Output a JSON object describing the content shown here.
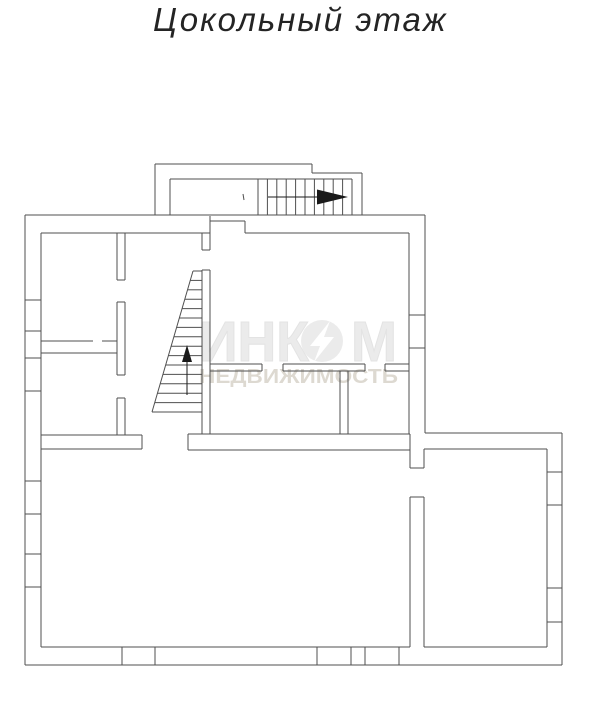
{
  "title": "Цокольный этаж",
  "watermark": {
    "brand_left": "ИНК",
    "brand_right": "М",
    "subtitle": "НЕДВИЖИМОСТЬ",
    "color_big": "#ebebeb",
    "color_big_outline": "#e3e3e3",
    "color_bolt": "#ffffff",
    "color_sub": "#ddd9d1"
  },
  "plan": {
    "stroke": "#4f4f4f",
    "arrow_color": "#1a1a1a",
    "groups": {
      "walls": {
        "lines": [
          [
            25,
            215,
            425,
            215
          ],
          [
            425,
            215,
            425,
            433
          ],
          [
            425,
            433,
            562,
            433
          ],
          [
            562,
            433,
            562,
            665
          ],
          [
            562,
            665,
            25,
            665
          ],
          [
            25,
            665,
            25,
            215
          ],
          [
            41,
            233,
            210,
            233
          ],
          [
            245,
            233,
            409,
            233
          ],
          [
            210,
            216,
            210,
            233
          ],
          [
            210,
            221,
            245,
            221
          ],
          [
            245,
            221,
            245,
            233
          ],
          [
            41,
            233,
            41,
            647
          ],
          [
            41,
            647,
            410,
            647
          ],
          [
            409,
            233,
            409,
            434
          ],
          [
            424,
            449,
            547,
            449
          ],
          [
            547,
            449,
            547,
            647
          ],
          [
            424,
            647,
            547,
            647
          ],
          [
            410,
            434,
            410,
            468
          ],
          [
            424,
            449,
            424,
            468
          ],
          [
            410,
            468,
            424,
            468
          ],
          [
            410,
            497,
            424,
            497
          ],
          [
            410,
            497,
            410,
            647
          ],
          [
            424,
            497,
            424,
            647
          ],
          [
            41,
            435,
            142,
            435
          ],
          [
            41,
            449,
            142,
            449
          ],
          [
            142,
            435,
            142,
            449
          ],
          [
            188,
            434,
            410,
            434
          ],
          [
            188,
            450,
            410,
            450
          ],
          [
            188,
            434,
            188,
            450
          ],
          [
            117,
            233,
            117,
            280
          ],
          [
            125,
            233,
            125,
            280
          ],
          [
            117,
            280,
            125,
            280
          ],
          [
            117,
            302,
            117,
            375
          ],
          [
            125,
            302,
            125,
            375
          ],
          [
            117,
            302,
            125,
            302
          ],
          [
            117,
            375,
            125,
            375
          ],
          [
            117,
            398,
            117,
            435
          ],
          [
            125,
            398,
            125,
            435
          ],
          [
            117,
            398,
            125,
            398
          ],
          [
            41,
            341,
            93,
            341
          ],
          [
            102,
            341,
            117,
            341
          ],
          [
            41,
            353,
            117,
            353
          ],
          [
            210,
            364,
            262,
            364
          ],
          [
            210,
            371,
            262,
            371
          ],
          [
            262,
            364,
            262,
            371
          ],
          [
            283,
            364,
            365,
            364
          ],
          [
            283,
            371,
            365,
            371
          ],
          [
            283,
            364,
            283,
            371
          ],
          [
            365,
            364,
            365,
            371
          ],
          [
            385,
            364,
            409,
            364
          ],
          [
            385,
            371,
            409,
            371
          ],
          [
            385,
            364,
            385,
            371
          ],
          [
            340,
            371,
            340,
            434
          ],
          [
            348,
            371,
            348,
            434
          ],
          [
            202,
            233,
            202,
            250
          ],
          [
            210,
            233,
            210,
            250
          ],
          [
            202,
            250,
            210,
            250
          ],
          [
            202,
            270,
            202,
            434
          ],
          [
            210,
            270,
            210,
            434
          ],
          [
            202,
            270,
            210,
            270
          ]
        ]
      },
      "windows": {
        "lines": [
          [
            25,
            300,
            41,
            300
          ],
          [
            25,
            331,
            41,
            331
          ],
          [
            25,
            358,
            41,
            358
          ],
          [
            25,
            391,
            41,
            391
          ],
          [
            25,
            481,
            41,
            481
          ],
          [
            25,
            514,
            41,
            514
          ],
          [
            25,
            554,
            41,
            554
          ],
          [
            25,
            587,
            41,
            587
          ],
          [
            122,
            647,
            122,
            665
          ],
          [
            155,
            647,
            155,
            665
          ],
          [
            317,
            647,
            317,
            665
          ],
          [
            351,
            647,
            351,
            665
          ],
          [
            365,
            647,
            365,
            665
          ],
          [
            399,
            647,
            399,
            665
          ],
          [
            409,
            315,
            425,
            315
          ],
          [
            409,
            348,
            425,
            348
          ],
          [
            547,
            472,
            562,
            472
          ],
          [
            547,
            505,
            562,
            505
          ],
          [
            547,
            588,
            562,
            588
          ],
          [
            547,
            622,
            562,
            622
          ]
        ]
      },
      "vestibule": {
        "lines": [
          [
            155,
            215,
            155,
            164
          ],
          [
            155,
            164,
            312,
            164
          ],
          [
            312,
            164,
            312,
            173
          ],
          [
            312,
            173,
            362,
            173
          ],
          [
            362,
            173,
            362,
            215
          ],
          [
            170,
            215,
            170,
            179
          ],
          [
            170,
            179,
            352,
            179
          ],
          [
            352,
            179,
            352,
            215
          ],
          [
            258,
            179,
            258,
            215
          ],
          [
            267.4,
            179,
            267.4,
            215
          ],
          [
            276.8,
            179,
            276.8,
            215
          ],
          [
            286.2,
            179,
            286.2,
            215
          ],
          [
            295.6,
            179,
            295.6,
            215
          ],
          [
            305,
            179,
            305,
            215
          ],
          [
            314.4,
            179,
            314.4,
            215
          ],
          [
            323.8,
            179,
            323.8,
            215
          ],
          [
            333.2,
            179,
            333.2,
            215
          ],
          [
            342.6,
            179,
            342.6,
            215
          ],
          [
            243,
            194,
            244,
            200
          ]
        ]
      },
      "interior_stair": {
        "lines": [
          [
            193,
            271,
            152,
            412
          ],
          [
            193,
            271,
            202,
            271
          ],
          [
            190.3,
            280.4,
            202,
            280.4
          ],
          [
            187.5,
            289.8,
            202,
            289.8
          ],
          [
            184.8,
            299.2,
            202,
            299.2
          ],
          [
            182.1,
            308.6,
            202,
            308.6
          ],
          [
            179.3,
            318,
            202,
            318
          ],
          [
            176.6,
            327.4,
            202,
            327.4
          ],
          [
            173.9,
            336.8,
            202,
            336.8
          ],
          [
            171.1,
            346.2,
            202,
            346.2
          ],
          [
            168.4,
            355.6,
            202,
            355.6
          ],
          [
            165.7,
            365,
            202,
            365
          ],
          [
            162.9,
            374.4,
            202,
            374.4
          ],
          [
            160.2,
            383.8,
            202,
            383.8
          ],
          [
            157.5,
            393.2,
            202,
            393.2
          ],
          [
            154.7,
            402.6,
            202,
            402.6
          ],
          [
            152,
            412,
            202,
            412
          ]
        ]
      },
      "arrows": {
        "lines": [
          [
            268,
            197,
            318,
            197
          ],
          [
            187,
            360,
            187,
            395
          ]
        ],
        "polygons": [
          "348,197 317,189.5 317,204.5",
          "187,345 182,362 192,362"
        ]
      }
    }
  }
}
